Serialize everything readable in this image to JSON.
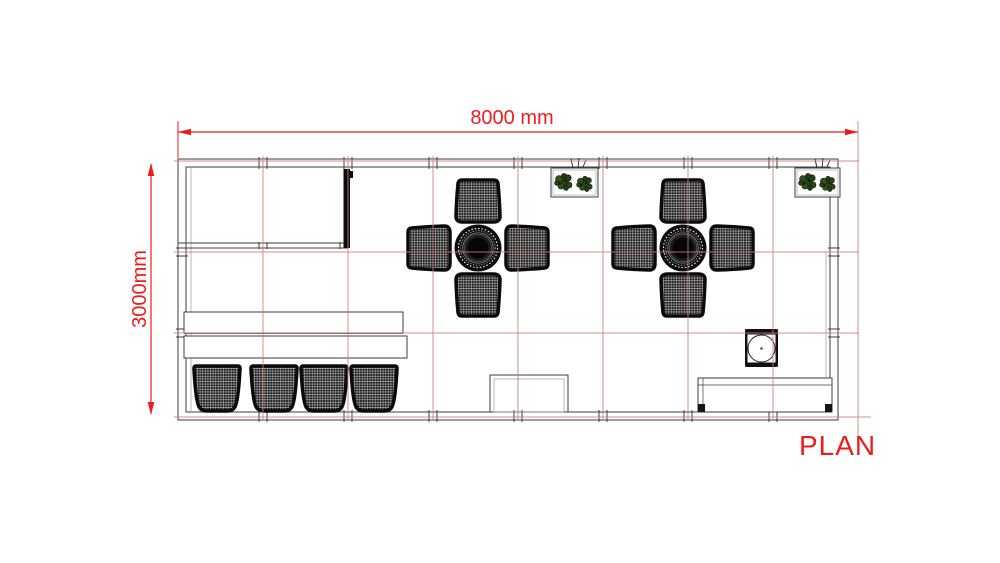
{
  "labels": {
    "width_dimension": "8000 mm",
    "height_dimension": "3000mm",
    "view_title": "PLAN"
  },
  "colors": {
    "background": "#ffffff",
    "dimension_red": "#ee1c1c",
    "grid_red": "#c97c74",
    "wall_gray": "#3e3e3e",
    "light_line_gray": "#9a9a9a",
    "furniture_black": "#101010",
    "plant_green": "#2e461c"
  }
}
